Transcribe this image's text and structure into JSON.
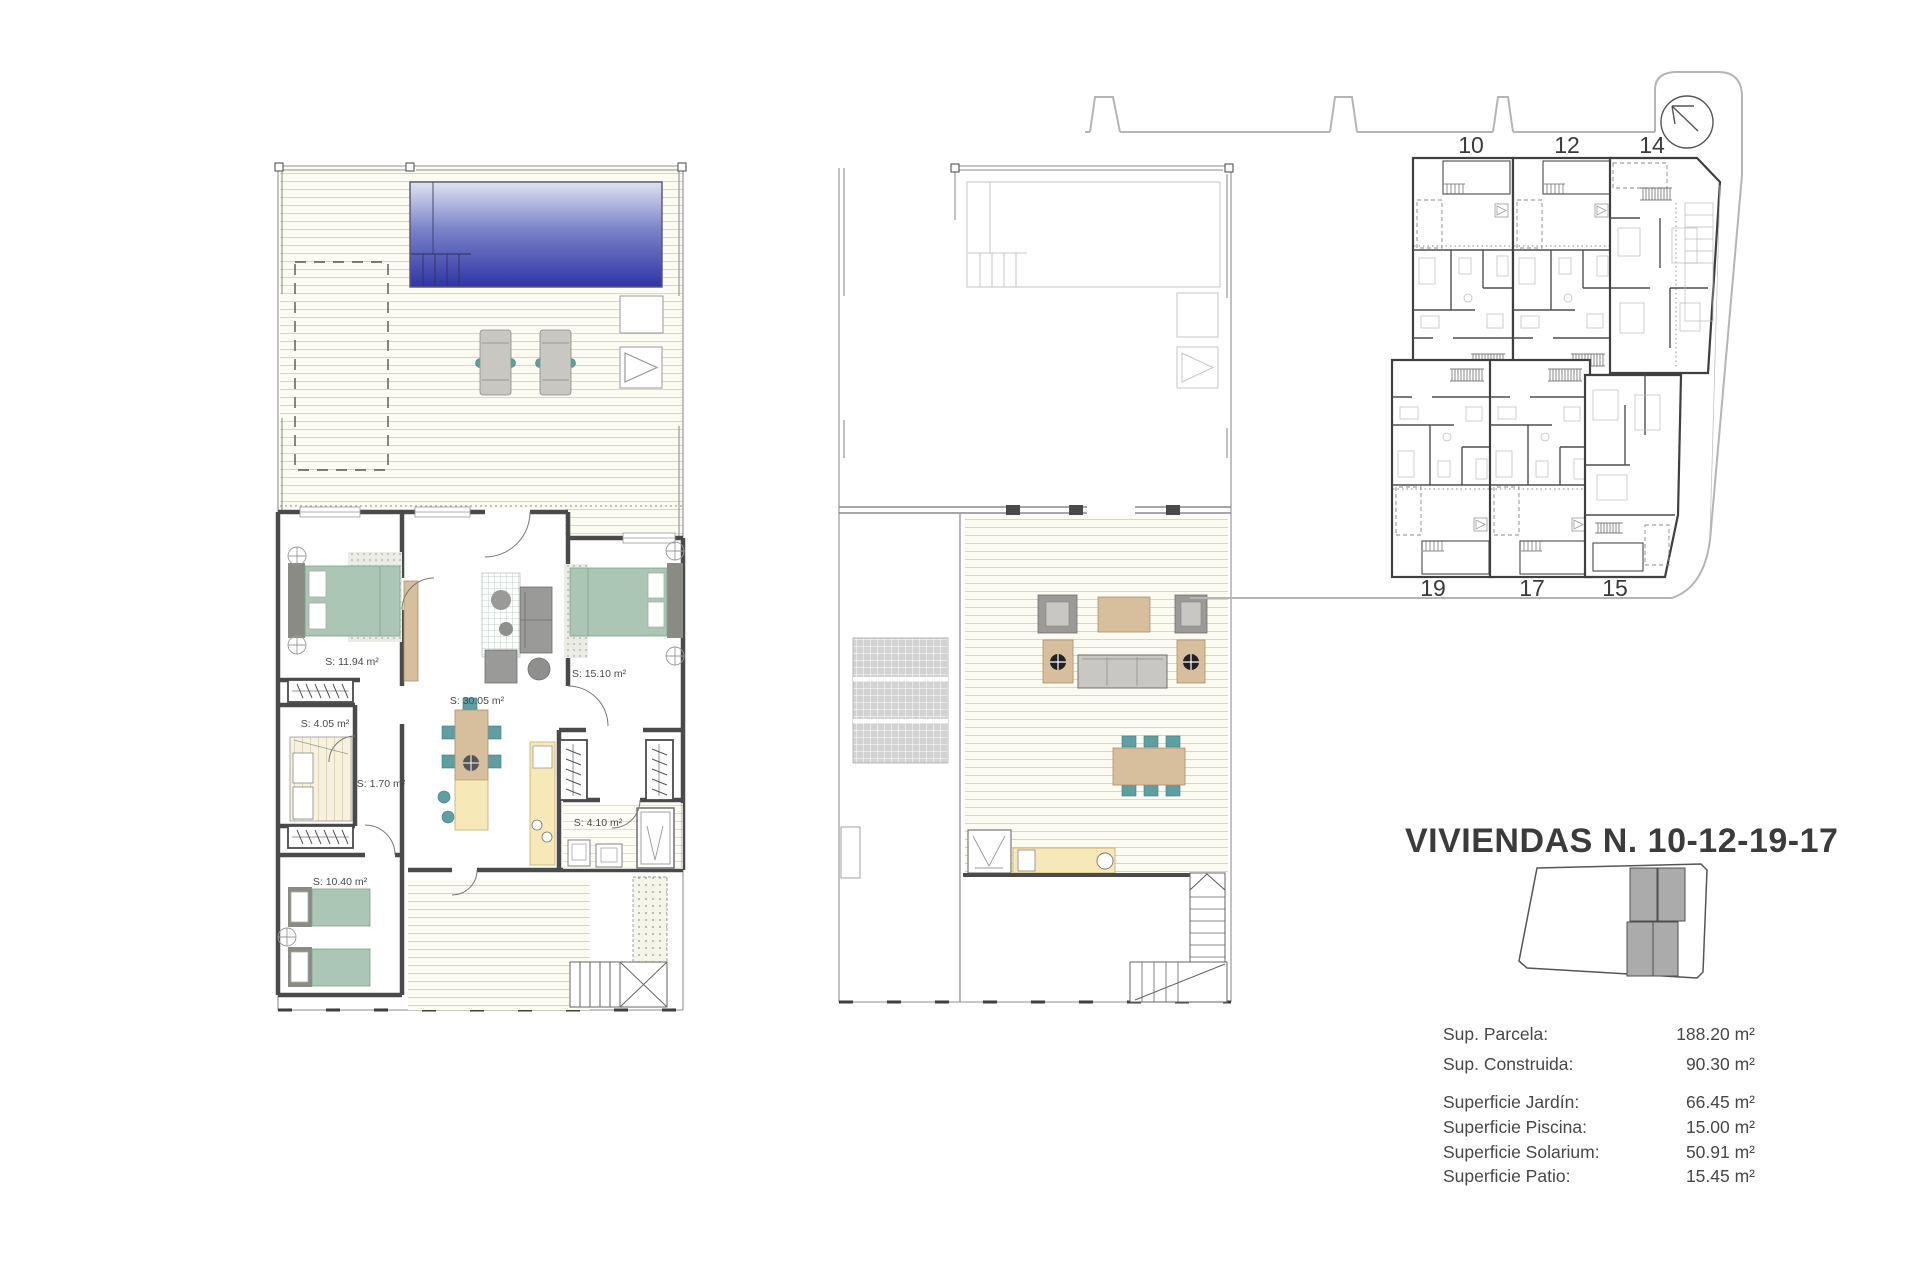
{
  "title_block": {
    "title": "VIVIENDAS N. 10-12-19-17",
    "areas": [
      {
        "label": "Sup. Parcela:",
        "value": "188.20 m²"
      },
      {
        "label": "Sup. Construida:",
        "value": "90.30 m²"
      },
      {
        "label": "Superficie Jardín:",
        "value": "66.45 m²"
      },
      {
        "label": "Superficie Piscina:",
        "value": "15.00 m²"
      },
      {
        "label": "Superficie Solarium:",
        "value": "50.91 m²"
      },
      {
        "label": "Superficie Patio:",
        "value": "15.45 m²"
      }
    ]
  },
  "ground_floor": {
    "room_labels": [
      "S: 11.94 m²",
      "S: 15.10 m²",
      "S: 30.05 m²",
      "S: 4.05 m²",
      "S: 1.70 m²",
      "S: 4.10 m²",
      "S: 10.40 m²"
    ]
  },
  "site_plan": {
    "units_top": [
      "10",
      "12",
      "14"
    ],
    "units_bottom": [
      "19",
      "17",
      "15"
    ]
  },
  "colors": {
    "pool_light": "#dfe2f1",
    "pool_mid": "#7b83c8",
    "pool_deep": "#2e35a6",
    "bed_green": "#abc6b4",
    "furniture_tan": "#d7bf9e",
    "kitchen_yellow": "#f7e8b8",
    "chair_teal": "#5f9fa1",
    "sofa_gray": "#9a9a98",
    "key_gray": "#ababab",
    "wall_dark": "#4a4a4a",
    "text_dark": "#3b3b3b"
  }
}
